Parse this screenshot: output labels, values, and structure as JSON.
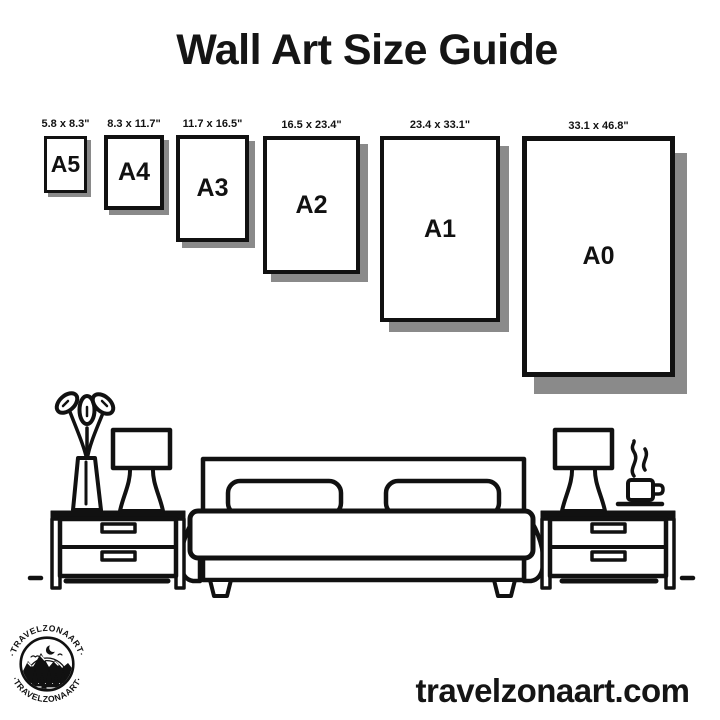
{
  "title": "Wall Art Size Guide",
  "website": "travelzonaart.com",
  "logo": {
    "arc_text_top": "·TRAVELZONAART·",
    "arc_text_bottom": "·TRAVELZONAART·"
  },
  "colors": {
    "ink": "#111111",
    "frame_shadow": "#8a8a8a",
    "background": "#ffffff"
  },
  "sizes": [
    {
      "code": "A5",
      "dimensions": "5.8 x 8.3\""
    },
    {
      "code": "A4",
      "dimensions": "8.3 x 11.7\""
    },
    {
      "code": "A3",
      "dimensions": "11.7 x 16.5\""
    },
    {
      "code": "A2",
      "dimensions": "16.5 x 23.4\""
    },
    {
      "code": "A1",
      "dimensions": "23.4 x 33.1\""
    },
    {
      "code": "A0",
      "dimensions": "33.1 x 46.8\""
    }
  ],
  "illustration": {
    "scene": "bedroom",
    "icons": [
      "bed-icon",
      "pillow-icon",
      "nightstand-icon",
      "table-lamp-icon",
      "plant-vase-icon",
      "coffee-cup-icon",
      "steam-icon",
      "moon-icon",
      "mountains-icon",
      "pine-trees-icon",
      "water-icon"
    ]
  }
}
